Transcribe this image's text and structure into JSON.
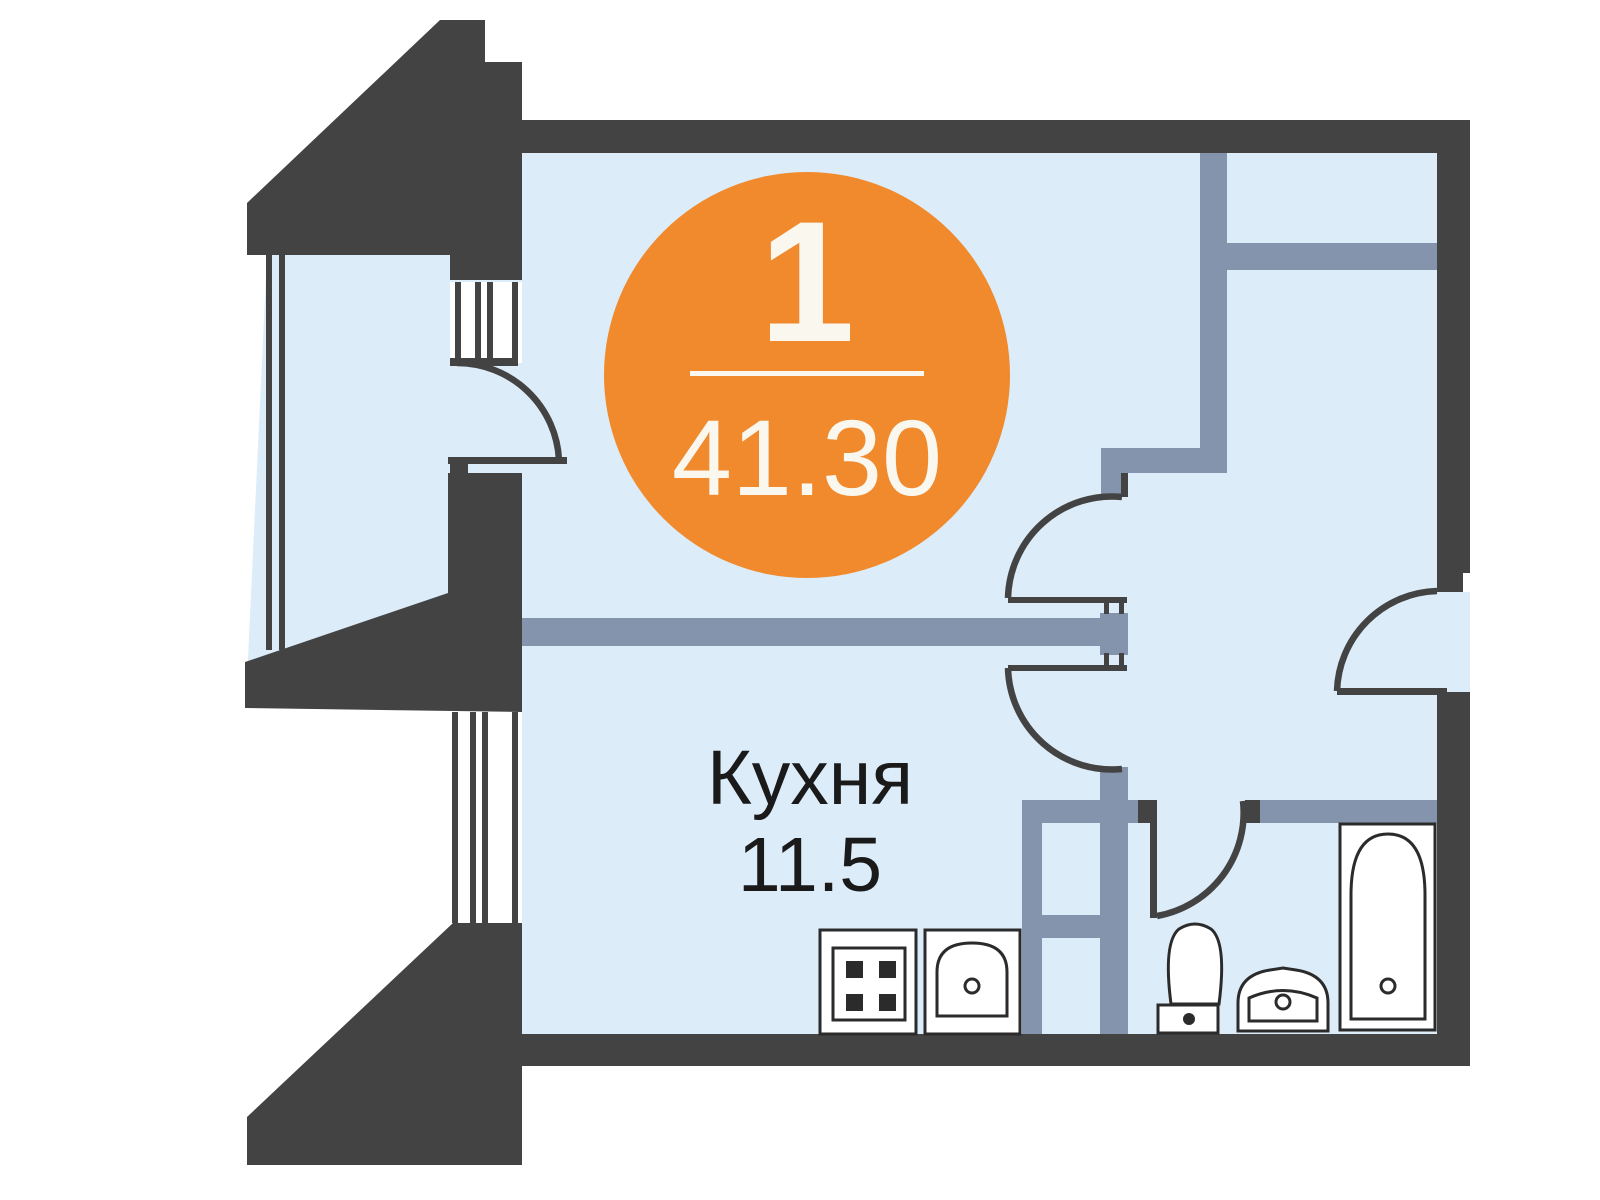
{
  "colors": {
    "wall": "#434343",
    "partition": "#8494ac",
    "floor": "#dcecf8",
    "accent_orange": "#f08a2c",
    "badge_text": "#faf7ef",
    "label_text": "#1a1a1a",
    "fixture_outline": "#2b2b2b"
  },
  "badge": {
    "rooms_count": "1",
    "area_total": "41.30"
  },
  "rooms": [
    {
      "name": "Кухня",
      "area": "11.5"
    }
  ],
  "icons": [
    "stove-icon",
    "kitchen-sink-icon",
    "toilet-icon",
    "washbasin-icon",
    "bathtub-icon",
    "vent-shaft-icon",
    "door-arc-icon",
    "window-icon"
  ]
}
